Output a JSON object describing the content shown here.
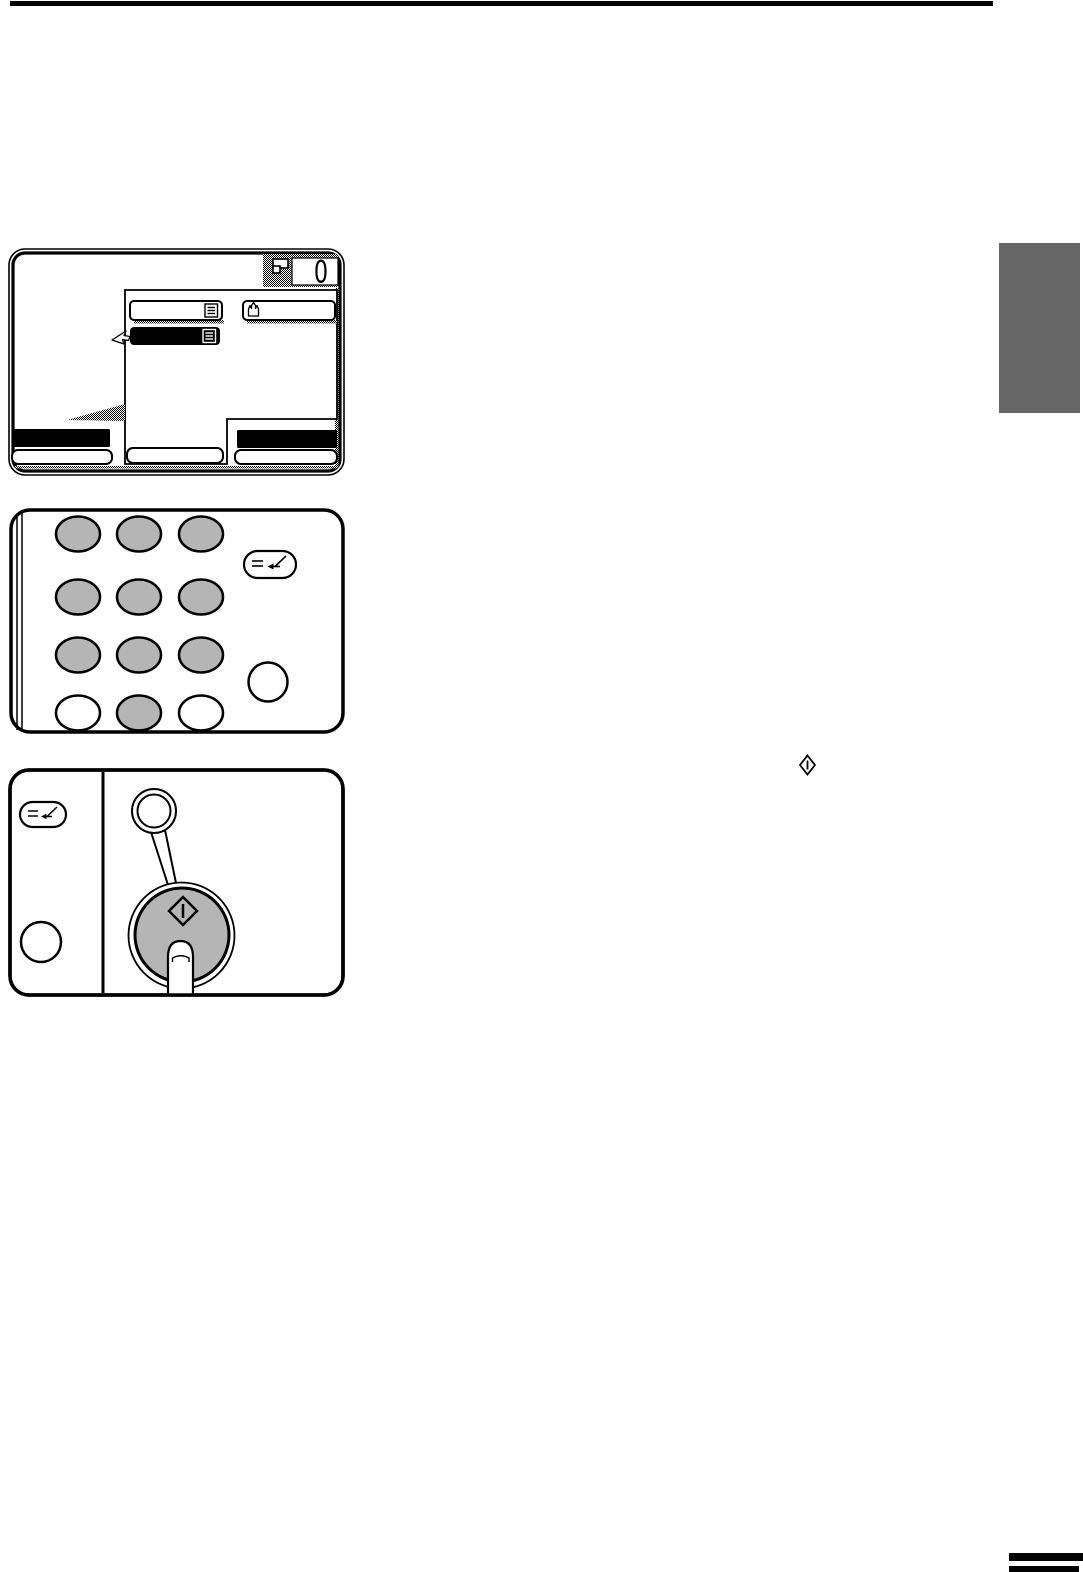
{
  "page": {
    "background_color": "#ffffff",
    "top_rule_color": "#000000",
    "chapter_tab_color": "#666666",
    "footer_marker_color": "#000000"
  },
  "display_panel": {
    "name": "touchscreen-display-illustration",
    "copy_counter": {
      "value": "0",
      "icon": "copies-icon",
      "background": "dither-gray"
    },
    "popup_menu": {
      "items": [
        {
          "position": "top-left",
          "icon": "list-icon",
          "state": "normal"
        },
        {
          "position": "top-right",
          "icon": "hand-icon",
          "state": "normal"
        },
        {
          "position": "second-row",
          "icon": "list-icon-inverse",
          "state": "selected"
        }
      ],
      "selected_bg": "#000000",
      "cursor": "pointer-cursor"
    },
    "bottom_bars": {
      "left_black": "#000000",
      "right_black": "#000000",
      "outline_buttons": "#ffffff"
    },
    "highlight_wedge": "dither-triangle"
  },
  "keypad_panel": {
    "name": "numeric-keypad-illustration",
    "key_rows": [
      [
        "gray",
        "gray",
        "gray"
      ],
      [
        "gray",
        "gray",
        "gray"
      ],
      [
        "gray",
        "gray",
        "gray"
      ],
      [
        "white",
        "gray",
        "white"
      ]
    ],
    "key_colors": {
      "gray": "#b5b5b5",
      "white": "#ffffff"
    },
    "program_key_icon": "program-enter-icon",
    "extra_round_key": "clear-key"
  },
  "start_panel": {
    "name": "start-key-illustration",
    "program_key_icon": "program-enter-icon",
    "round_key": "interrupt-key",
    "indicator": "start-indicator-lamp",
    "start_button": {
      "icon": "start-diamond-icon",
      "fill": "#b5b5b5",
      "pressed_by": "finger"
    }
  },
  "inline_symbols": {
    "start_key_symbol": "start-diamond-icon"
  }
}
